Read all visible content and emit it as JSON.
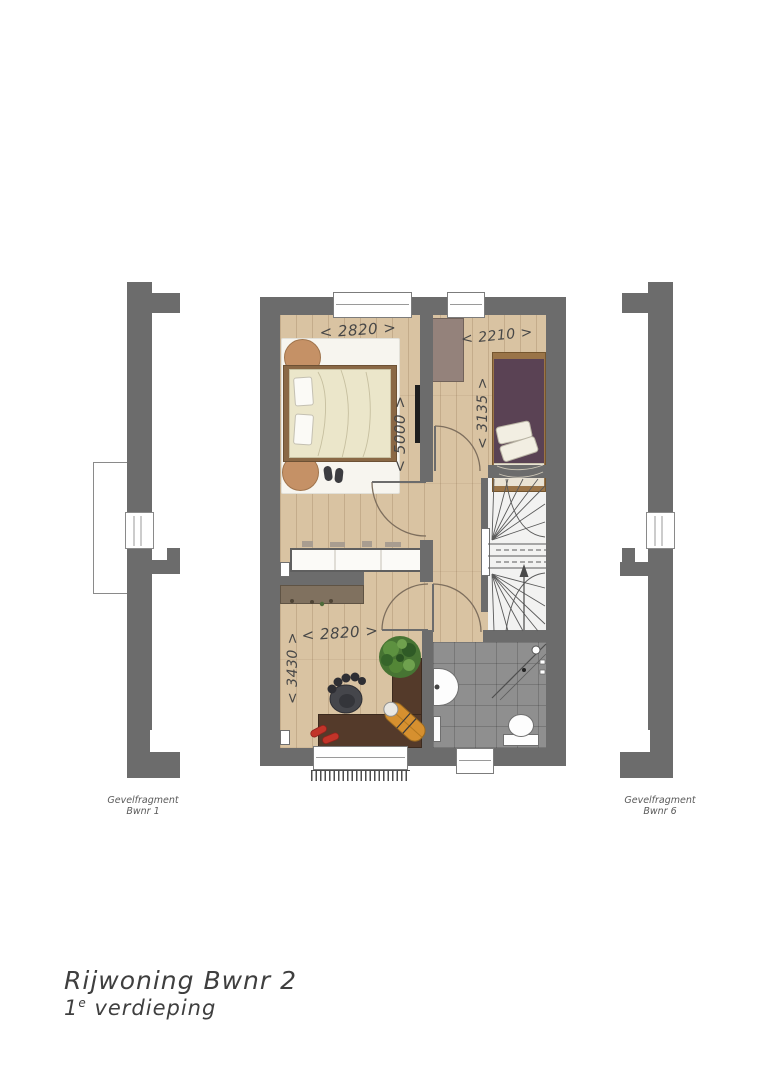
{
  "title": {
    "line1": "Rijwoning Bwnr 2",
    "line2_num": "1",
    "line2_sup": "e",
    "line2_rest": "verdieping"
  },
  "fragments": {
    "left": {
      "line1": "Gevelfragment",
      "line2": "Bwnr 1"
    },
    "right": {
      "line1": "Gevelfragment",
      "line2": "Bwnr 6"
    }
  },
  "dimensions": {
    "bedroom1_width": "< 2820 >",
    "bedroom1_depth": "< 5000 >",
    "bedroom2_width": "< 2210 >",
    "bedroom2_depth": "< 3135 >",
    "study_width": "< 2820 >",
    "study_depth": "< 3430 >"
  },
  "colors": {
    "wall": "#6c6c6c",
    "floor_wood": "#d9c3a2",
    "bathroom_tile": "#8f8f8f",
    "stairs_floor": "#f2f2f1",
    "rug": "#f7f5ef",
    "bed1_frame": "#8a6845",
    "bed1_duvet": "#ebe6ca",
    "pouf": "#c59166",
    "bed2_frame": "#9a7448",
    "bed2_duvet": "#5a4254",
    "closet_white": "#fbfaf7",
    "dresser": "#80715f",
    "closet2": "#94827b",
    "desk": "#543a2a",
    "chair": "#45464b",
    "bag": "#d6902f",
    "shoes": "#c23429",
    "plant": "#477433",
    "dim_text": "#474747"
  }
}
